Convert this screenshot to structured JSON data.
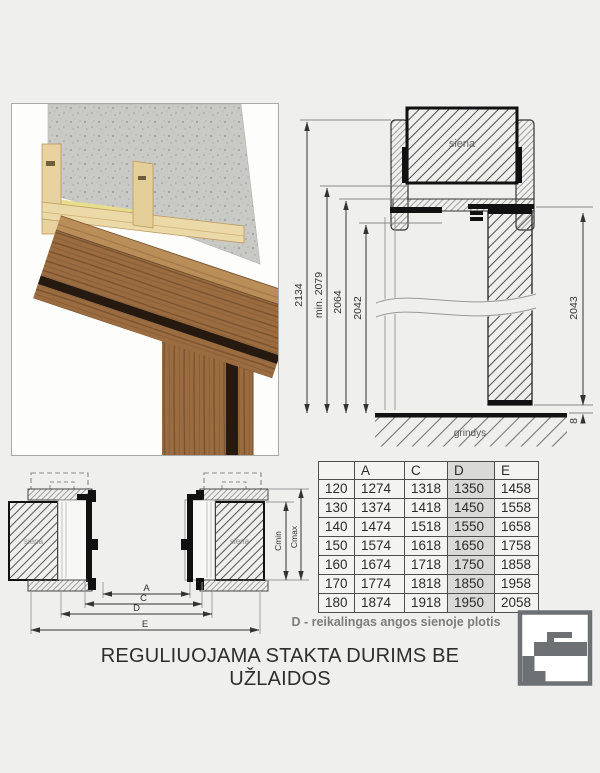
{
  "document": {
    "title": "REGULIUOJAMA STAKTA DURIMS BE UŽLAIDOS",
    "note": "D - reikalingas angos sienoje plotis"
  },
  "vertical_section": {
    "wall_label": "siena",
    "floor_label": "grindys",
    "dim_total": "2134",
    "dim_min": "min. 2079",
    "dim_frame": "2064",
    "dim_opening": "2042",
    "dim_leaf": "2043",
    "dim_gap": "8"
  },
  "horizontal_section": {
    "wall_label": "siena",
    "dim_a": "A",
    "dim_c": "C",
    "dim_d": "D",
    "dim_e": "E",
    "dim_cmin": "Cmin",
    "dim_cmax": "Cmax"
  },
  "table": {
    "headers": [
      "",
      "A",
      "C",
      "D",
      "E"
    ],
    "highlighted_column": "D",
    "rows": [
      [
        "120",
        "1274",
        "1318",
        "1350",
        "1458"
      ],
      [
        "130",
        "1374",
        "1418",
        "1450",
        "1558"
      ],
      [
        "140",
        "1474",
        "1518",
        "1550",
        "1658"
      ],
      [
        "150",
        "1574",
        "1618",
        "1650",
        "1758"
      ],
      [
        "160",
        "1674",
        "1718",
        "1750",
        "1858"
      ],
      [
        "170",
        "1774",
        "1818",
        "1850",
        "1958"
      ],
      [
        "180",
        "1874",
        "1918",
        "1950",
        "2058"
      ]
    ]
  },
  "colors": {
    "page_background": "#efefee",
    "table_highlight": "#d9d9d7",
    "note_text": "#7d7d7d",
    "logo_gray": "#6d7174",
    "wood": "#9a6c40",
    "mdf": "#e8d3a0",
    "concrete": "#c9c9c6"
  }
}
